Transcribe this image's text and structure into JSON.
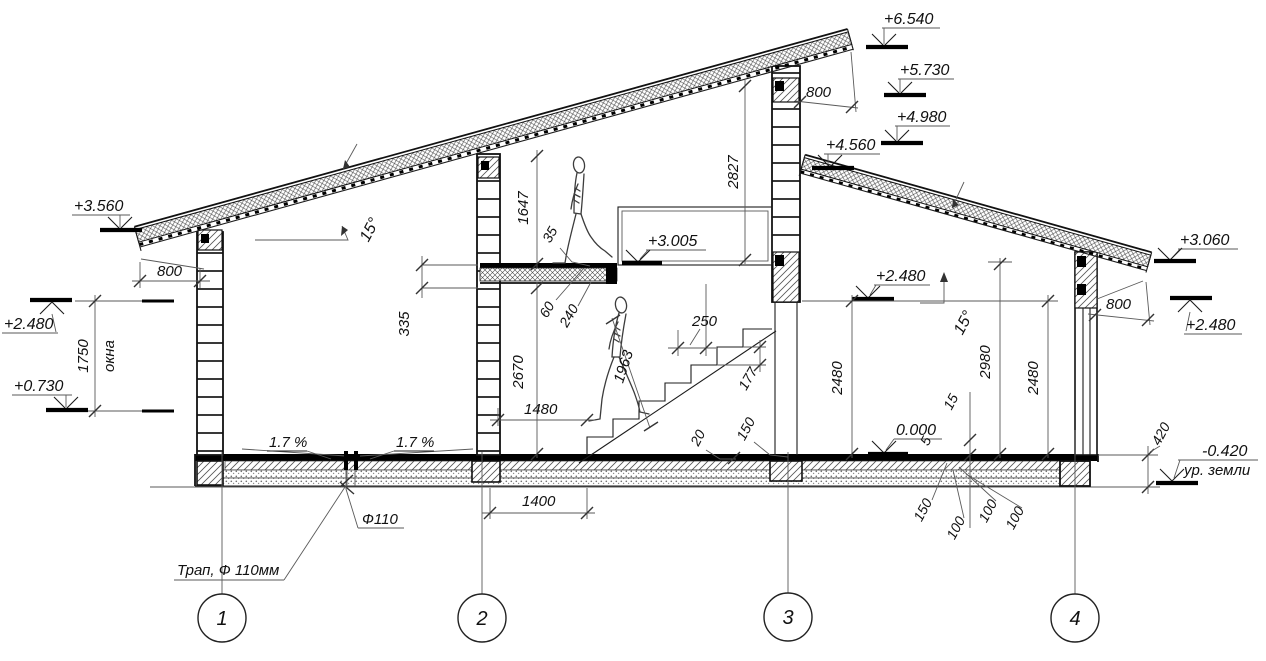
{
  "drawing": {
    "elevations": {
      "top1": "+6.540",
      "top2": "+5.730",
      "top3": "+4.980",
      "top4": "+4.560",
      "left_eaves": "+3.560",
      "left_window_head": "+2.480",
      "left_window_sill": "+0.730",
      "landing": "+3.005",
      "room_right": "+2.480",
      "right_window_head": "+2.480",
      "right_eaves": "+3.060",
      "floor": "0.000",
      "ground": "-0.420"
    },
    "ground_label": "ур. земли",
    "window_label": "окна",
    "slope_roof": "15°",
    "slope_floor": "1.7 %",
    "drain_short": "Ф110",
    "drain_full": "Трап, Ф 110мм",
    "dims": {
      "overhang": "800",
      "window_h": "1750",
      "attic_h": "1647",
      "wall3_h": "2827",
      "slab_offset": "335",
      "floor_h": "2670",
      "stair_w": "1480",
      "stair_w2": "1400",
      "tread": "250",
      "riser": "177",
      "headroom": "1963",
      "slab_top": "60",
      "slab": "240",
      "gap35": "35",
      "room_h": "2480",
      "room_mid": "2980",
      "d20": "20",
      "d150": "150",
      "d100": "100",
      "d420": "420",
      "d15": "15",
      "d5": "5"
    },
    "axes": {
      "a1": "1",
      "a2": "2",
      "a3": "3",
      "a4": "4"
    }
  }
}
